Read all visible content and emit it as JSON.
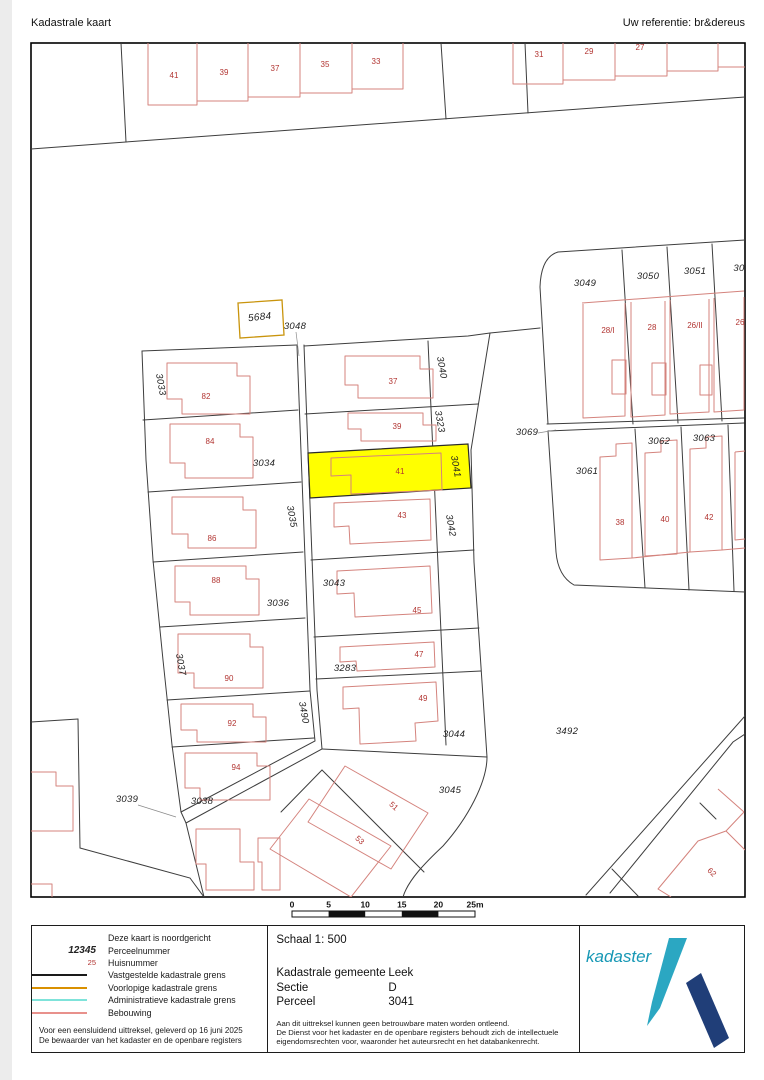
{
  "header": {
    "title": "Kadastrale kaart",
    "reference": "Uw referentie: br&dereus"
  },
  "map": {
    "highlight_color": "#ffff00",
    "provisional_boundary_color": "#c9940c",
    "parcel_labels": [
      {
        "t": "5684",
        "x": 260,
        "y": 320,
        "r": -6,
        "s": 10
      },
      {
        "t": "3048",
        "x": 295,
        "y": 329
      },
      {
        "t": "3033",
        "x": 158,
        "y": 385,
        "r": 80
      },
      {
        "t": "3034",
        "x": 264,
        "y": 466
      },
      {
        "t": "3035",
        "x": 289,
        "y": 517,
        "r": 80
      },
      {
        "t": "3036",
        "x": 278,
        "y": 606
      },
      {
        "t": "3037",
        "x": 178,
        "y": 665,
        "r": 80
      },
      {
        "t": "3490",
        "x": 301,
        "y": 713,
        "r": 80
      },
      {
        "t": "3038",
        "x": 202,
        "y": 804
      },
      {
        "t": "3039",
        "x": 127,
        "y": 802
      },
      {
        "t": "3040",
        "x": 439,
        "y": 368,
        "r": 80
      },
      {
        "t": "3323",
        "x": 437,
        "y": 422,
        "r": 80
      },
      {
        "t": "3041",
        "x": 453,
        "y": 467,
        "r": 80
      },
      {
        "t": "3042",
        "x": 448,
        "y": 526,
        "r": 80
      },
      {
        "t": "3043",
        "x": 334,
        "y": 586
      },
      {
        "t": "3283",
        "x": 345,
        "y": 671
      },
      {
        "t": "3044",
        "x": 454,
        "y": 737
      },
      {
        "t": "3045",
        "x": 450,
        "y": 793
      },
      {
        "t": "3492",
        "x": 567,
        "y": 734
      },
      {
        "t": "3049",
        "x": 585,
        "y": 286
      },
      {
        "t": "3050",
        "x": 648,
        "y": 279
      },
      {
        "t": "3051",
        "x": 695,
        "y": 274
      },
      {
        "t": "30",
        "x": 739,
        "y": 271
      },
      {
        "t": "3069",
        "x": 527,
        "y": 435
      },
      {
        "t": "3061",
        "x": 587,
        "y": 474
      },
      {
        "t": "3062",
        "x": 659,
        "y": 444
      },
      {
        "t": "3063",
        "x": 704,
        "y": 441
      }
    ],
    "house_numbers": [
      {
        "t": "41",
        "x": 174,
        "y": 78
      },
      {
        "t": "39",
        "x": 224,
        "y": 75
      },
      {
        "t": "37",
        "x": 275,
        "y": 71
      },
      {
        "t": "35",
        "x": 325,
        "y": 67
      },
      {
        "t": "33",
        "x": 376,
        "y": 64
      },
      {
        "t": "31",
        "x": 539,
        "y": 57
      },
      {
        "t": "29",
        "x": 589,
        "y": 54
      },
      {
        "t": "27",
        "x": 640,
        "y": 50
      },
      {
        "t": "82",
        "x": 206,
        "y": 399
      },
      {
        "t": "84",
        "x": 210,
        "y": 444
      },
      {
        "t": "86",
        "x": 212,
        "y": 541
      },
      {
        "t": "88",
        "x": 216,
        "y": 583
      },
      {
        "t": "90",
        "x": 229,
        "y": 681
      },
      {
        "t": "92",
        "x": 232,
        "y": 726
      },
      {
        "t": "94",
        "x": 236,
        "y": 770
      },
      {
        "t": "37",
        "x": 393,
        "y": 384
      },
      {
        "t": "39",
        "x": 397,
        "y": 429
      },
      {
        "t": "41",
        "x": 400,
        "y": 474
      },
      {
        "t": "43",
        "x": 402,
        "y": 518
      },
      {
        "t": "45",
        "x": 417,
        "y": 613
      },
      {
        "t": "47",
        "x": 419,
        "y": 657
      },
      {
        "t": "49",
        "x": 423,
        "y": 701
      },
      {
        "t": "51",
        "x": 392,
        "y": 808,
        "r": 42
      },
      {
        "t": "53",
        "x": 358,
        "y": 842,
        "r": 42
      },
      {
        "t": "28/I",
        "x": 608,
        "y": 333
      },
      {
        "t": "28",
        "x": 652,
        "y": 330
      },
      {
        "t": "26/II",
        "x": 695,
        "y": 328
      },
      {
        "t": "26",
        "x": 740,
        "y": 325
      },
      {
        "t": "38",
        "x": 620,
        "y": 525
      },
      {
        "t": "40",
        "x": 665,
        "y": 522
      },
      {
        "t": "42",
        "x": 709,
        "y": 520
      },
      {
        "t": "62",
        "x": 710,
        "y": 874,
        "r": 45
      }
    ],
    "scale_bar": {
      "labels": [
        "0",
        "5",
        "10",
        "15",
        "20",
        "25m"
      ]
    }
  },
  "footer": {
    "legend": {
      "north_note": "Deze kaart is noordgericht",
      "parcel_sample": "12345",
      "parcel_label": "Perceelnummer",
      "house_sample": "25",
      "house_label": "Huisnummer",
      "line_items": [
        {
          "label": "Vastgestelde kadastrale grens",
          "color": "#1a1a1a"
        },
        {
          "label": "Voorlopige kadastrale grens",
          "color": "#d99000"
        },
        {
          "label": "Administratieve kadastrale grens",
          "color": "#7fe3da"
        },
        {
          "label": "Bebouwing",
          "color": "#e8918c"
        }
      ],
      "footnote1": "Voor een eensluidend uittreksel, geleverd op 16 juni 2025",
      "footnote2": "De bewaarder van het kadaster en de openbare registers"
    },
    "info": {
      "scale_label": "Schaal 1: 500",
      "rows": [
        {
          "label": "Kadastrale gemeente",
          "value": "Leek"
        },
        {
          "label": "Sectie",
          "value": "D"
        },
        {
          "label": "Perceel",
          "value": "3041"
        }
      ],
      "disclaimer": [
        "Aan dit uittreksel kunnen geen betrouwbare maten worden ontleend.",
        "De Dienst voor het kadaster en de openbare registers behoudt zich de intellectuele",
        "eigendomsrechten voor, waaronder het auteursrecht en het databankenrecht."
      ]
    },
    "logo": {
      "text": "kadaster",
      "text_color": "#1798b5",
      "nib_color": "#2ba7c2",
      "beam_color": "#203e78"
    }
  }
}
